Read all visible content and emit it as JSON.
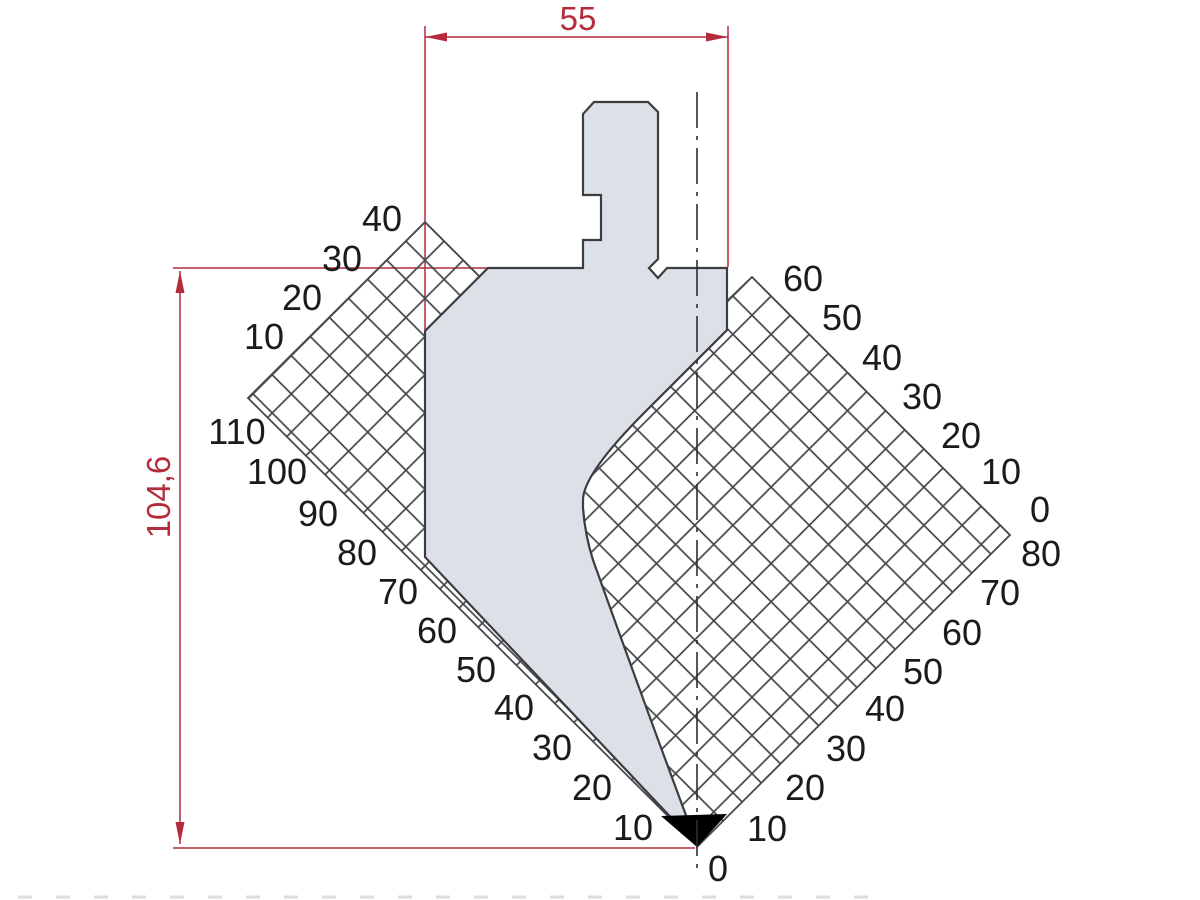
{
  "drawing": {
    "title": "Press brake punch cross-section with face measurement grids",
    "dimensions": {
      "width": "55",
      "height": "104,6"
    },
    "colors": {
      "dimension_red": "#b42c3c",
      "punch_fill": "#dce1e8",
      "outline_dark": "#3b3d40",
      "grid_line": "#46484b",
      "label_text": "#1a1b1d",
      "tip_black": "#000000",
      "background": "#ffffff"
    },
    "scales": {
      "left_upper": [
        {
          "label": "40",
          "x": 382,
          "y": 231
        },
        {
          "label": "30",
          "x": 342,
          "y": 271
        },
        {
          "label": "20",
          "x": 302,
          "y": 310
        },
        {
          "label": "10",
          "x": 264,
          "y": 349
        }
      ],
      "left_lower": [
        {
          "label": "110",
          "x": 237,
          "y": 444
        },
        {
          "label": "100",
          "x": 277,
          "y": 484
        },
        {
          "label": "90",
          "x": 318,
          "y": 526
        },
        {
          "label": "80",
          "x": 357,
          "y": 565
        },
        {
          "label": "70",
          "x": 398,
          "y": 604
        },
        {
          "label": "60",
          "x": 437,
          "y": 643
        },
        {
          "label": "50",
          "x": 476,
          "y": 682
        },
        {
          "label": "40",
          "x": 514,
          "y": 720
        },
        {
          "label": "30",
          "x": 552,
          "y": 760
        },
        {
          "label": "20",
          "x": 592,
          "y": 800
        },
        {
          "label": "10",
          "x": 633,
          "y": 840
        }
      ],
      "right_upper": [
        {
          "label": "60",
          "x": 803,
          "y": 291
        },
        {
          "label": "50",
          "x": 842,
          "y": 330
        },
        {
          "label": "40",
          "x": 882,
          "y": 370
        },
        {
          "label": "30",
          "x": 922,
          "y": 409
        },
        {
          "label": "20",
          "x": 961,
          "y": 448
        },
        {
          "label": "10",
          "x": 1001,
          "y": 484
        },
        {
          "label": "0",
          "x": 1040,
          "y": 522
        }
      ],
      "right_lower": [
        {
          "label": "80",
          "x": 1041,
          "y": 566
        },
        {
          "label": "70",
          "x": 1000,
          "y": 605
        },
        {
          "label": "60",
          "x": 962,
          "y": 645
        },
        {
          "label": "50",
          "x": 923,
          "y": 684
        },
        {
          "label": "40",
          "x": 885,
          "y": 721
        },
        {
          "label": "30",
          "x": 846,
          "y": 761
        },
        {
          "label": "20",
          "x": 805,
          "y": 800
        },
        {
          "label": "10",
          "x": 767,
          "y": 841
        }
      ],
      "origin": {
        "label": "0",
        "x": 718,
        "y": 881
      }
    }
  }
}
